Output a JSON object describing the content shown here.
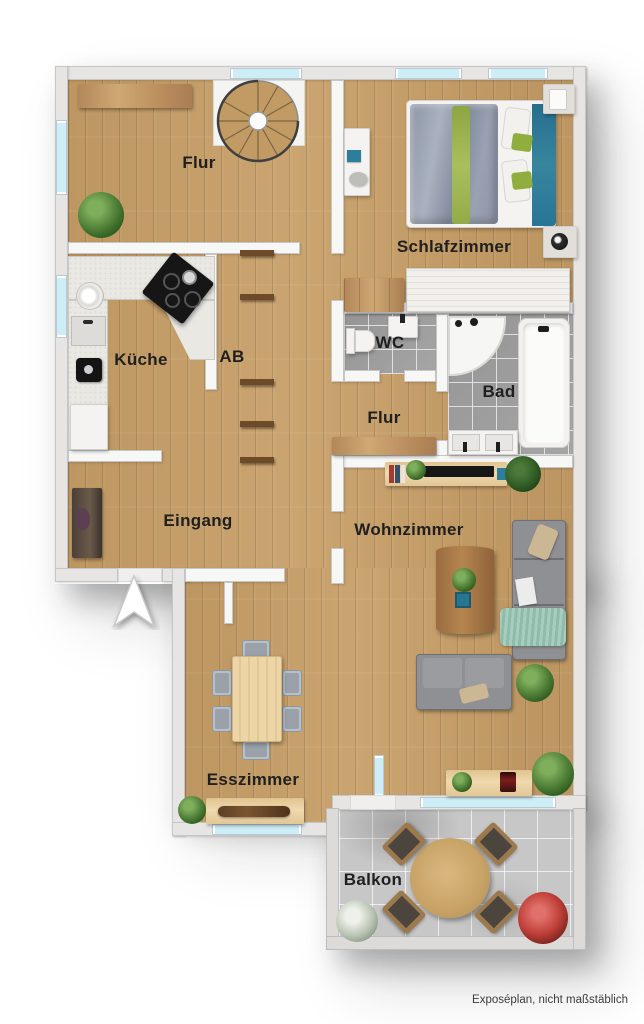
{
  "plan": {
    "rooms": [
      {
        "id": "flur_og",
        "label": "Flur"
      },
      {
        "id": "schlafzimmer",
        "label": "Schlafzimmer"
      },
      {
        "id": "kueche",
        "label": "Küche"
      },
      {
        "id": "ab",
        "label": "AB"
      },
      {
        "id": "wc",
        "label": "WC"
      },
      {
        "id": "bad",
        "label": "Bad"
      },
      {
        "id": "flur_mitte",
        "label": "Flur"
      },
      {
        "id": "eingang",
        "label": "Eingang"
      },
      {
        "id": "wohnzimmer",
        "label": "Wohnzimmer"
      },
      {
        "id": "esszimmer",
        "label": "Esszimmer"
      },
      {
        "id": "balkon",
        "label": "Balkon"
      }
    ],
    "footer": {
      "disclaimer": "Exposéplan, nicht maßstäblich"
    },
    "palette": {
      "wood_floor": "#c79e66",
      "bath_tile": "#9e9e9e",
      "balcony_concrete": "#c7c7c7",
      "window_glass": "#cdeef6",
      "wall": "#f7f7f6",
      "accent_teal": "#2e7d9c",
      "accent_green": "#8fae3e",
      "sofa_gray": "#8f9094",
      "label_color": "#1f1f1f"
    }
  }
}
